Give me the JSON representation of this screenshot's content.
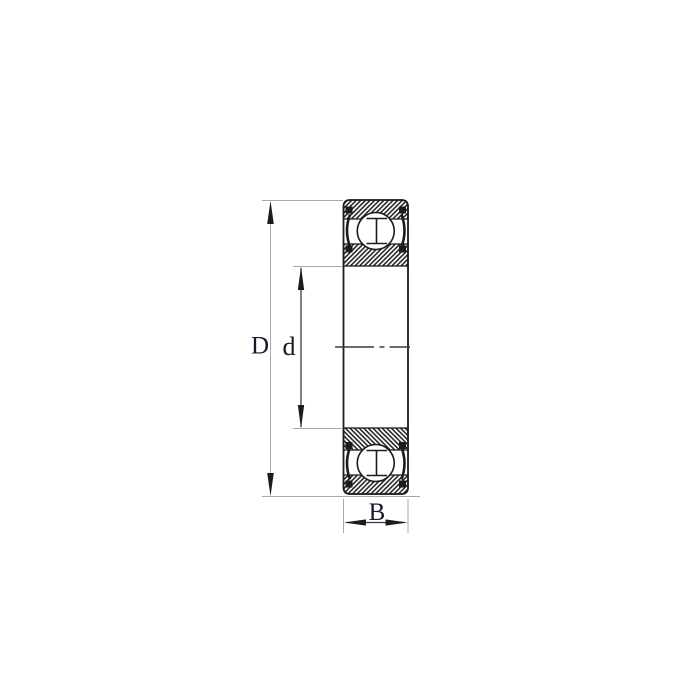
{
  "diagram": {
    "type": "deep-groove-ball-bearing-cross-section",
    "labels": {
      "outer_diameter": "D",
      "bore_diameter": "d",
      "width": "B"
    },
    "colors": {
      "line": "#1c1c1c",
      "dim_strong": "#3c3c3c",
      "dim_light": "#a8a8a8",
      "label_text": "#18182a",
      "background": "#ffffff"
    }
  }
}
